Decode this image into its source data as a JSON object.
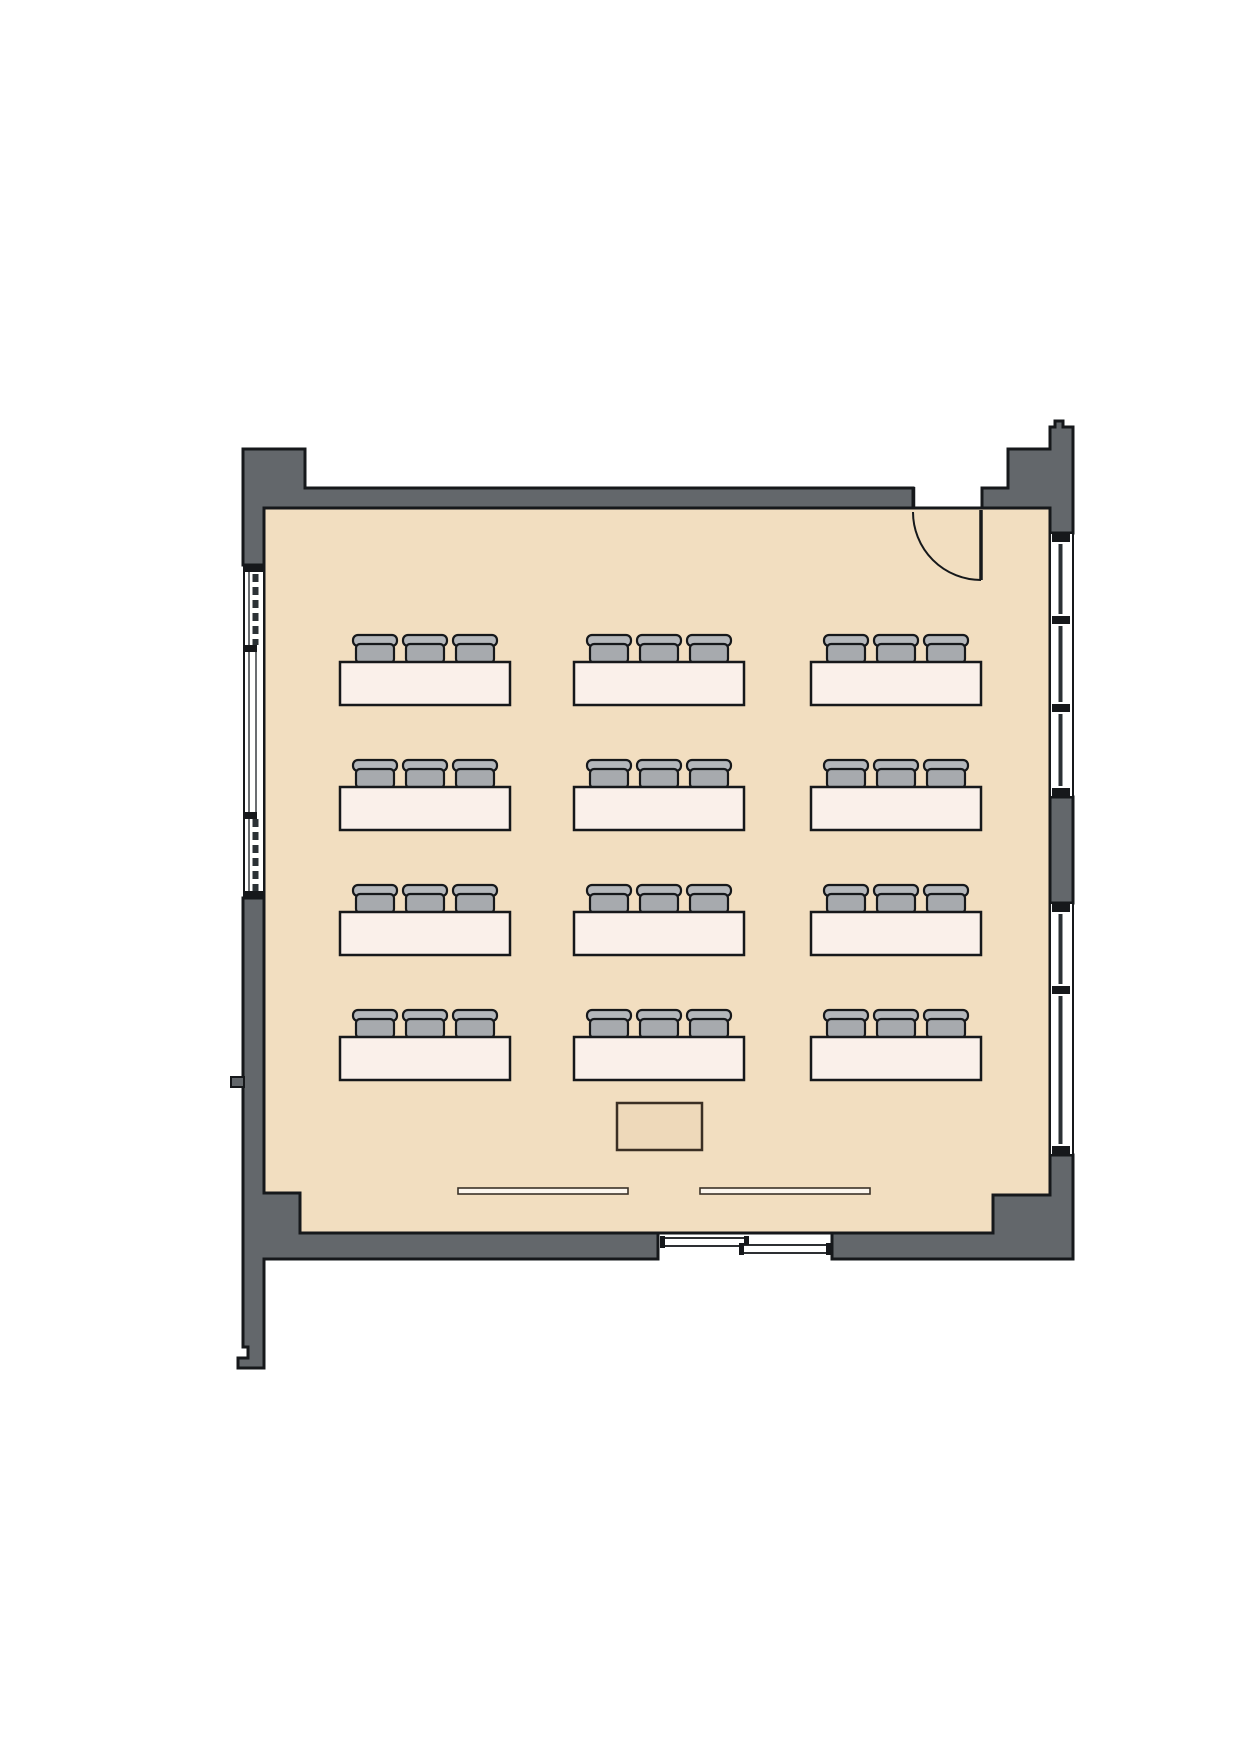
{
  "title": "classroom-floor-plan",
  "colors": {
    "floor": "#f2dec0",
    "wall": "#63676b",
    "outline": "#16181b",
    "glass": "#2b3135",
    "table_fill": "#faf0ea",
    "chair_seat": "#a7aaae",
    "chair_back": "#b4b7bb",
    "desk_fill": "#eed9ba",
    "desk_stroke": "#3b2f24",
    "board_fill": "#fcf6ee",
    "board_stroke": "#3b3228"
  },
  "summary": {
    "student_table_count": 12,
    "chair_count": 36,
    "rows": 4,
    "columns": 3
  },
  "furniture": {
    "student_tables": {
      "cols_x": [
        340,
        574,
        811
      ],
      "rows_y": [
        662,
        787,
        912,
        1037
      ],
      "table_width": 170,
      "table_height": 43,
      "chairs_per_table": 3,
      "chair_pitch": 50,
      "chair_back_width": 44,
      "chair_back_height": 11,
      "chair_seat_width": 38,
      "chair_seat_height": 19,
      "chair_total_height": 27
    },
    "teacher_desk": {
      "x": 617,
      "y": 1103,
      "width": 85,
      "height": 47
    },
    "boards": [
      {
        "x": 458,
        "y": 1188,
        "width": 170,
        "height": 6
      },
      {
        "x": 700,
        "y": 1188,
        "width": 170,
        "height": 6
      }
    ]
  },
  "openings": {
    "entry_door": {
      "wall": "top",
      "x1": 913,
      "x2": 982,
      "swing": "inward-hinge-right"
    },
    "sliding_door": {
      "wall": "bottom",
      "x1": 658,
      "x2": 832,
      "panels": 2
    }
  },
  "windows": {
    "left_wall": {
      "y_start": 565,
      "y_end": 898,
      "dashed_segments": [
        [
          574,
          645
        ],
        [
          819,
          891
        ]
      ],
      "clear_segment": [
        650,
        812
      ]
    },
    "right_wall_sections": [
      {
        "y_start": 533,
        "y_end": 797
      },
      {
        "y_start": 903,
        "y_end": 1155
      }
    ]
  }
}
